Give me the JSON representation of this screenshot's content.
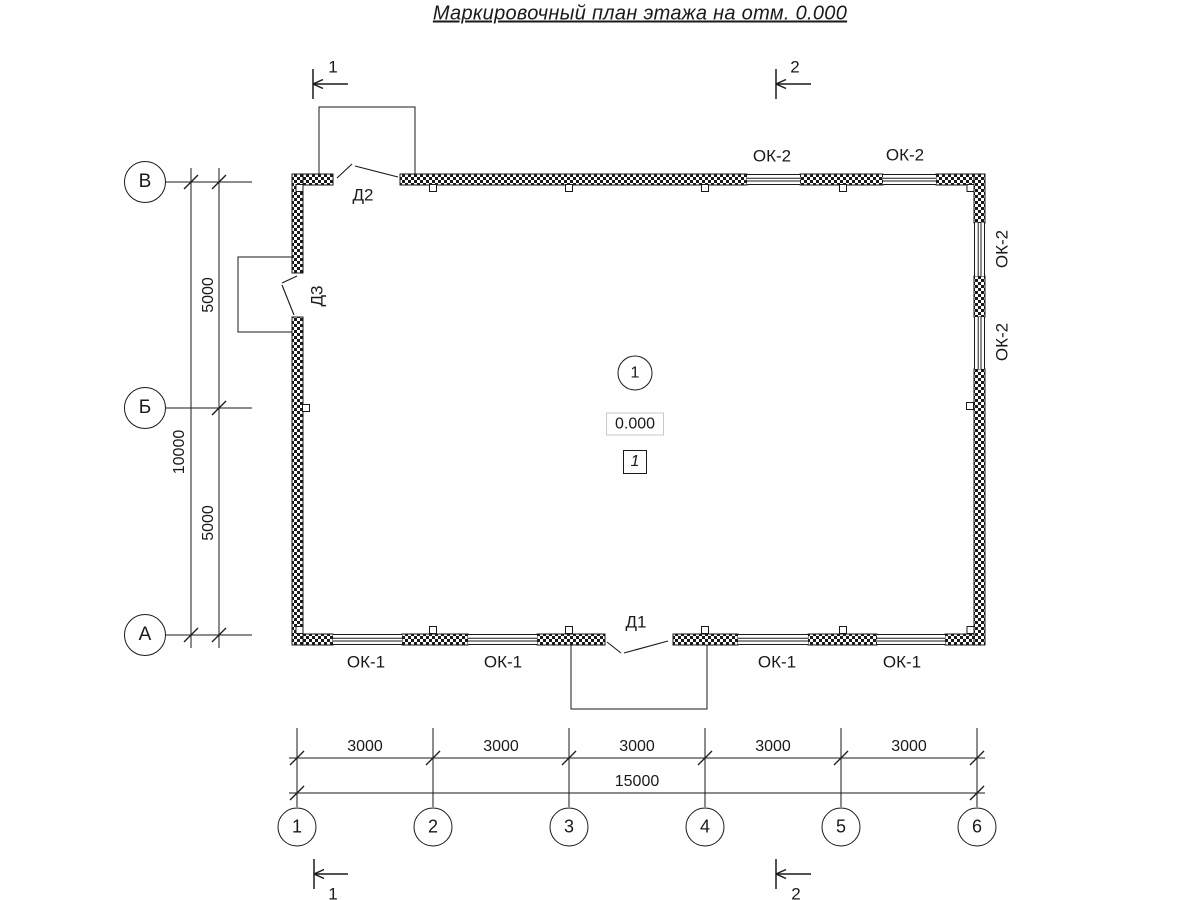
{
  "title": "Маркировочный план этажа на отм. 0.000",
  "axes": {
    "vertical": [
      "В",
      "Б",
      "А"
    ],
    "horizontal": [
      "1",
      "2",
      "3",
      "4",
      "5",
      "6"
    ]
  },
  "dims": {
    "left_upper": "5000",
    "left_lower": "5000",
    "left_total": "10000",
    "bottom_segments": [
      "3000",
      "3000",
      "3000",
      "3000",
      "3000"
    ],
    "bottom_total": "15000"
  },
  "windows": {
    "top": [
      "ОК-2",
      "ОК-2"
    ],
    "right": [
      "ОК-2",
      "ОК-2"
    ],
    "bottom": [
      "ОК-1",
      "ОК-1",
      "ОК-1",
      "ОК-1"
    ]
  },
  "doors": {
    "d1": "Д1",
    "d2": "Д2",
    "d3": "Д3"
  },
  "room": {
    "circle": "1",
    "elevation": "0.000",
    "number": "1"
  },
  "sections": {
    "top1": "1",
    "top2": "2",
    "bottom1": "1",
    "bottom2": "2"
  },
  "colors": {
    "line": "#1a1a1a",
    "elevation_box_border": "#c8c8c8"
  }
}
